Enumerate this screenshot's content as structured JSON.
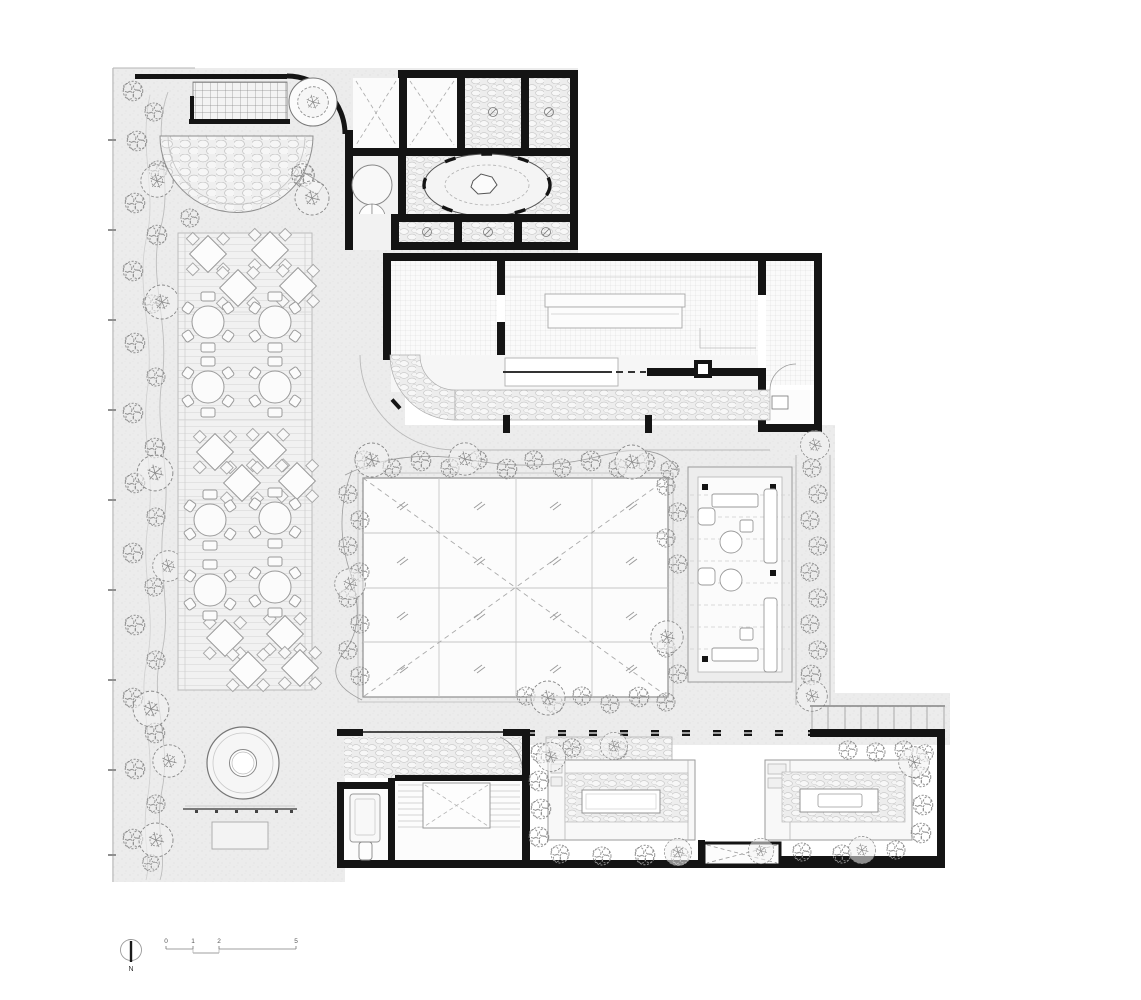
{
  "scale_bar": {
    "labels": [
      "0",
      "1",
      "2",
      "5"
    ]
  },
  "north_arrow": {
    "label": "N"
  },
  "colors": {
    "paper": "#ffffff",
    "ground": "#ececec",
    "wall": "#141414",
    "line_light": "#cccccc",
    "line_mid": "#9a9a9a",
    "plant": "#8f8f8f",
    "texture": "#c6c6c6"
  }
}
